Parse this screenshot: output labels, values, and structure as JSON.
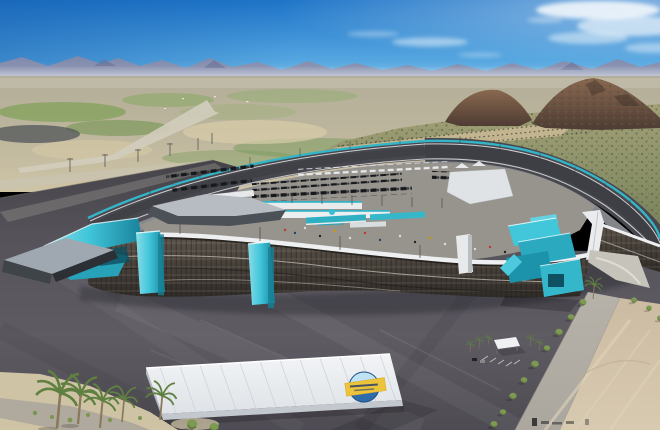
{
  "meta": {
    "description": "Aerial photorealistic rendering of a desert oval racetrack: curved grandstand with teal stair towers viewed from behind, infield garages and hauler rows, dark asphalt parking aprons, a white metal warehouse with a circular blue-and-yellow roof logo, palm trees, a tree-lined access road, tan dirt lot, desert plain, brown rocky hills, hazy mountain ridge and blue sky with wispy clouds. A tiny illegible watermark smudge sits at the bottom edge.",
    "visible_text": "none (roof logo lettering illegible)"
  },
  "palette": {
    "sky_top": "#1E74C8",
    "sky_mid": "#55A6E0",
    "sky_horizon": "#CDE9F7",
    "cloud_white": "#FFFFFF",
    "mountain_ridge": "#8187A8",
    "mountain_peak_shadow": "#6B7194",
    "horizon_haze": "#E8ECF2",
    "desert_base": "#BCB59C",
    "desert_green": "#7FA055",
    "desert_tan": "#D8CBA6",
    "desert_road": "#D2CDBD",
    "hillside_scrub_top": "#A3A178",
    "hillside_scrub_bottom": "#76815A",
    "hillside_rows_tan": "#C6B894",
    "hill_brown": "#8A6850",
    "hill_brown_dark": "#4E3C33",
    "track_asphalt": "#47474E",
    "track_dark": "#3C3C43",
    "track_apron": "#8B8B92",
    "wall_teal": "#34B5C7",
    "line_white": "#DEDEE0",
    "stand_steel_light": "#5E564D",
    "stand_steel_dark": "#2F2B27",
    "walkway_light": "#CFCAC0",
    "roof_white": "#EDEFF1",
    "teal_bright": "#41C6DA",
    "teal_mid": "#2AA9BF",
    "teal_dark": "#17829A",
    "lot_asphalt": "#56535B",
    "plaza_concrete": "#C6C3BB",
    "access_road": "#B6B2A9",
    "dirt_lot": "#CBBBA2",
    "dirt_streak": "#DFD3BB",
    "sand": "#CFC3A6",
    "sand_path": "#AAA59B",
    "warehouse_roof": "#F2F4F6",
    "warehouse_fascia": "#C2C8CD",
    "warehouse_rib": "#C9CFD5",
    "logo_blue": "#2E6CAB",
    "logo_sky": "#BFE3F2",
    "logo_ribbon": "#EDC33B",
    "tree_green": "#7D9A52",
    "tree_shade": "#5D7A3C",
    "palm_frond": "#5F8040",
    "palm_trunk": "#8A7A5C"
  }
}
